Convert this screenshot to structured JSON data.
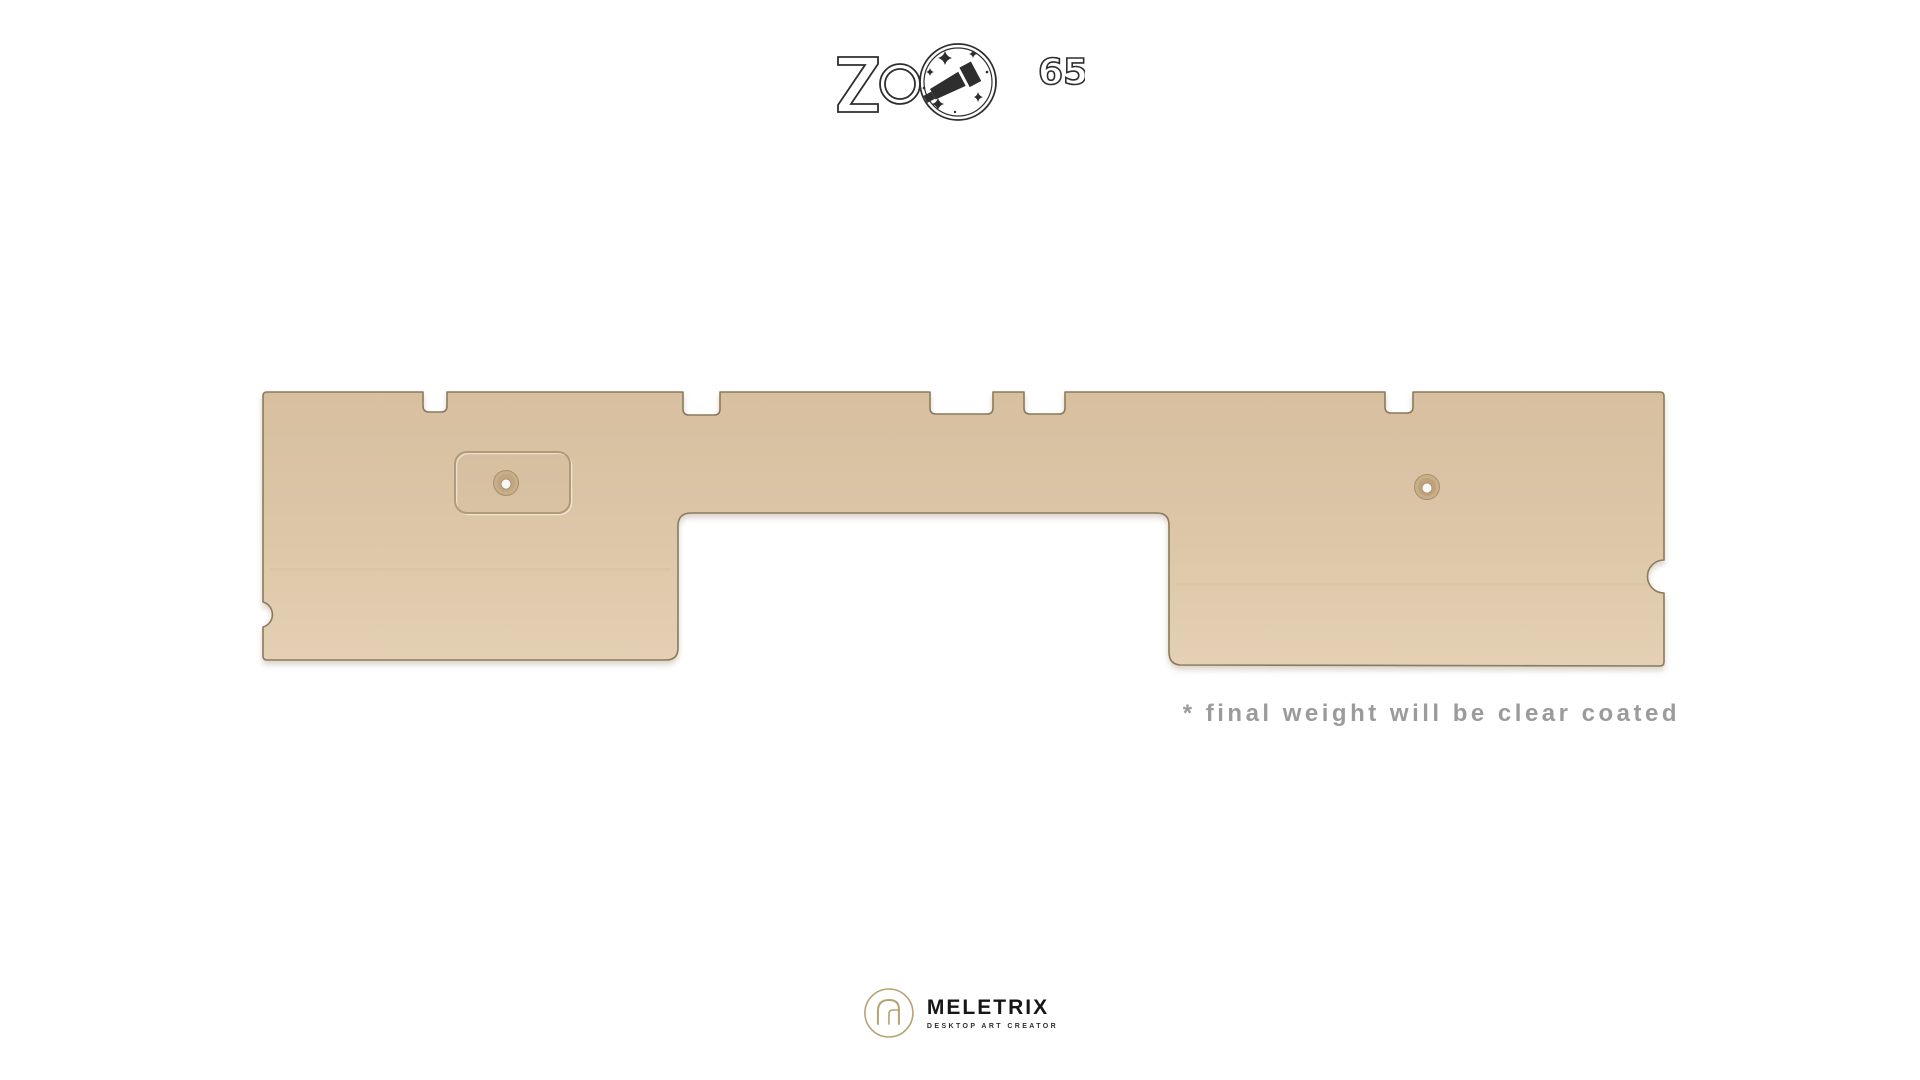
{
  "page": {
    "background_color": "#ffffff"
  },
  "header": {
    "brand_wordmark": "ZOOM",
    "brand_superscript": "65",
    "logo_ink": "#2e2e2e"
  },
  "product": {
    "body_color": "#dcc6a7",
    "body_color_top": "#d7bf9f",
    "body_color_bottom": "#e4d0b4",
    "edge_color": "#8b7a5e"
  },
  "caption": {
    "text": "* final weight will be clear coated",
    "color": "#9b9b9b"
  },
  "footer": {
    "brand": "MELETRIX",
    "tagline": "DESKTOP ART CREATOR",
    "emblem_color": "#b7a272",
    "text_color": "#161616"
  }
}
